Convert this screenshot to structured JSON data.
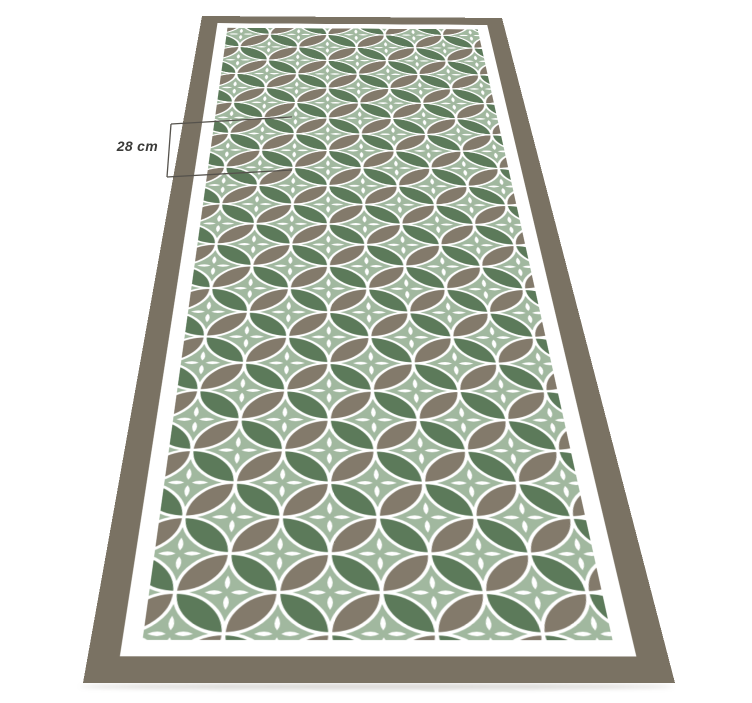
{
  "annotation": {
    "measurement_label": "28 cm"
  },
  "pattern": {
    "motif": "overlapping-circles-petal-tile",
    "elements": [
      "white-circle-outlines",
      "four-petal-white-flowers",
      "green-lens-petals",
      "taupe-lens-petals"
    ]
  },
  "colors": {
    "page-bg": "#ffffff",
    "frame": "#7a7263",
    "band": "#ffffff",
    "sage": "#a1b89f",
    "leaf-green": "#5c7a5a",
    "leaf-taupe": "#837a6b",
    "line": "#55524c",
    "text": "#3b3b39"
  }
}
